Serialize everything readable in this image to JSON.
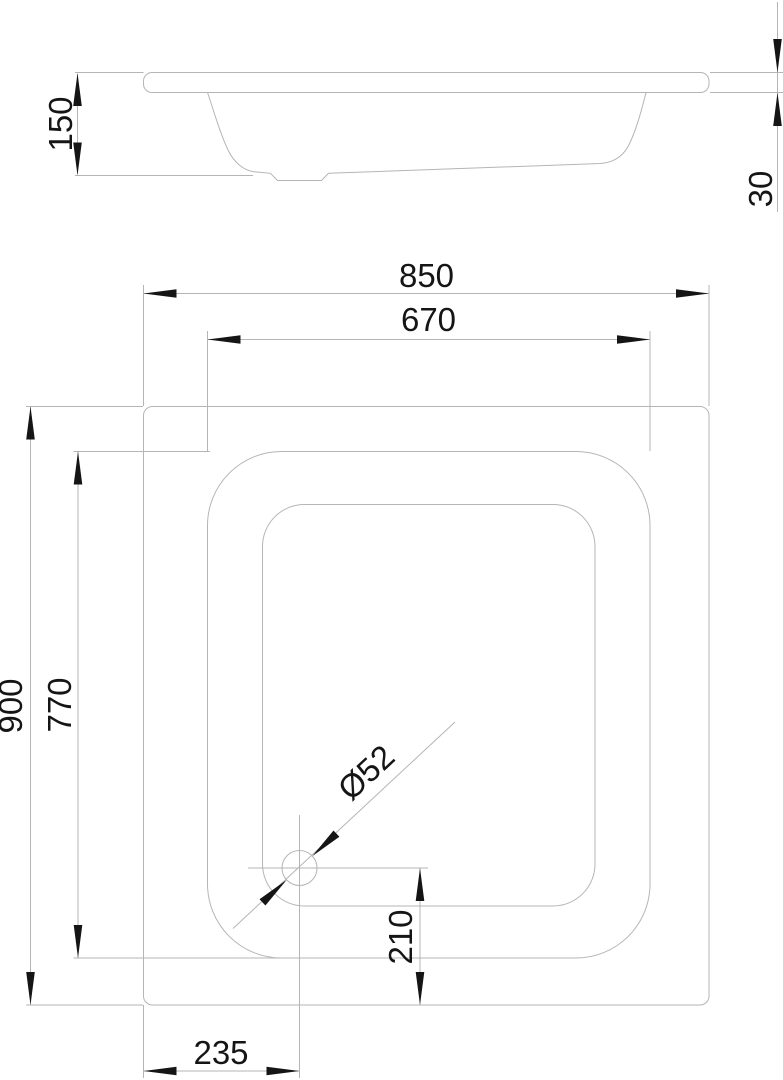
{
  "drawing": {
    "side_view": {
      "overall_height_label": "150",
      "rim_thickness_label": "30"
    },
    "plan_view": {
      "overall_width_label": "850",
      "basin_width_label": "670",
      "overall_depth_label": "900",
      "basin_depth_label": "770",
      "drain_diameter_label": "Ø52",
      "drain_offset_bottom_label": "210",
      "drain_offset_left_label": "235"
    },
    "colors": {
      "line": "#b5b5b5",
      "ink": "#151515",
      "background": "#ffffff"
    }
  }
}
